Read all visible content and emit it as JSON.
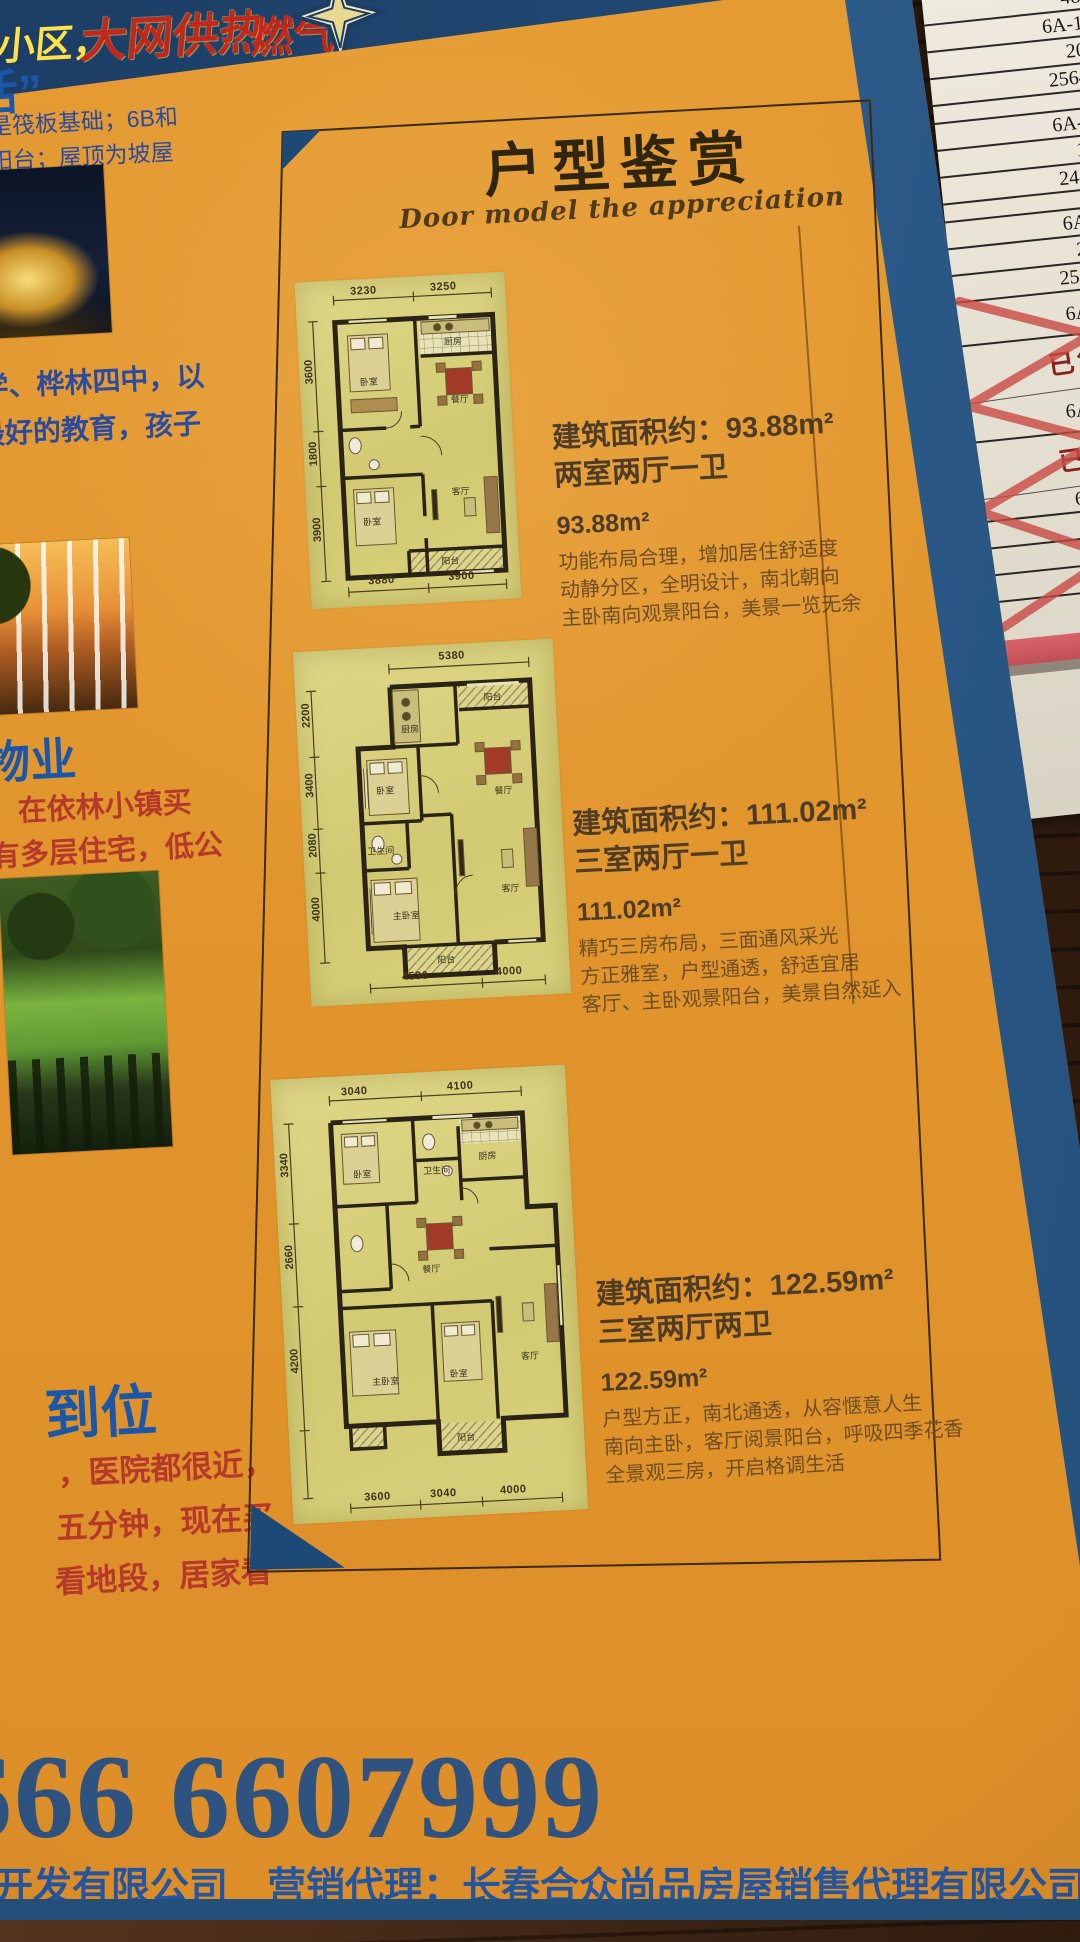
{
  "banner": {
    "community": "小区，",
    "heating": "大网供热",
    "gas": "燃气"
  },
  "left_column": {
    "slogan_tail": "生活”",
    "notes": [
      "其他是筏板基础；6B和",
      "落地式阳台；屋顶为坡屋"
    ],
    "education_lines": [
      "小学、桦林四中，以",
      "受最好的教育，孩子"
    ],
    "property_heading": "物业",
    "property_lines": [
      "，在依林小镇买",
      "有多层住宅，低公"
    ],
    "location_heading": "到位",
    "location_lines": [
      "，医院都很近，",
      "五分钟，现在买",
      "看地段，居家看"
    ]
  },
  "panel": {
    "title": "户型鉴赏",
    "subtitle": "Door model the appreciation",
    "plans": [
      {
        "area_line": "建筑面积约：93.88m²",
        "layout_line": "两室两厅一卫",
        "area": "93.88m²",
        "desc": [
          "功能布局合理，增加居住舒适度",
          "动静分区，全明设计，南北朝向",
          "主卧南向观景阳台，美景一览无余"
        ],
        "dims": {
          "top": [
            "3230",
            "3250"
          ],
          "left": [
            "3600",
            "1800",
            "3900"
          ],
          "bottom": [
            "3880",
            "3900"
          ]
        },
        "rooms": {
          "bed1": "卧室",
          "kitchen": "厨房",
          "dining": "餐厅",
          "bed2": "卧室",
          "living": "客厅",
          "balcony": "阳台"
        }
      },
      {
        "area_line": "建筑面积约：111.02m²",
        "layout_line": "三室两厅一卫",
        "area": "111.02m²",
        "desc": [
          "精巧三房布局，三面通风采光",
          "方正雅室，户型通透，舒适宜居",
          "客厅、主卧观景阳台，美景自然延入"
        ],
        "dims": {
          "top": [
            "5380"
          ],
          "left": [
            "2200",
            "3400",
            "2080",
            "4000"
          ],
          "bottom": [
            "4530",
            "4000"
          ]
        },
        "rooms": {
          "kitchen": "厨房",
          "top_balcony": "阳台",
          "bed": "卧室",
          "dining": "餐厅",
          "bath": "卫生间",
          "master": "主卧室",
          "living": "客厅",
          "balcony": "阳台"
        }
      },
      {
        "area_line": "建筑面积约：122.59m²",
        "layout_line": "三室两厅两卫",
        "area": "122.59m²",
        "desc": [
          "户型方正，南北通透，从容惬意人生",
          "南向主卧，客厅阅景阳台，呼吸四季花香",
          "全景观三房，开启格调生活"
        ],
        "dims": {
          "top": [
            "3040",
            "4100"
          ],
          "left": [
            "3340",
            "2660",
            "4200"
          ],
          "bottom": [
            "3600",
            "3040",
            "4000"
          ]
        },
        "rooms": {
          "bed1": "卧室",
          "bath": "卫生间",
          "kitchen": "厨房",
          "dining": "餐厅",
          "master": "主卧室",
          "bed2": "卧室",
          "living": "客厅",
          "balcony": "阳台"
        }
      }
    ]
  },
  "footer": {
    "phone": "666  6607999",
    "agency_line": "开发有限公司　营销代理：长春合众尚品房屋销售代理有限公司"
  },
  "side_papers": {
    "rows": [
      "西",
      "123",
      "48",
      "6A-1",
      "20",
      "2564",
      "6A-1",
      "19",
      "2441",
      "6A-1",
      "208",
      "25644"
    ],
    "sold_rows": [
      "6A-1-",
      "6A-1-2",
      "6A-1-1",
      "2180",
      "68772",
      "750000"
    ],
    "sold_label": "已售"
  },
  "colors": {
    "flyer_orange": "#e2952e",
    "navy": "#1d4474",
    "band_blue": "#2e6190",
    "heading_blue": "#1b57a8",
    "red_text": "#b5392a",
    "plan_paper": "#d7d07b",
    "phone_blue": "#2e5380"
  }
}
